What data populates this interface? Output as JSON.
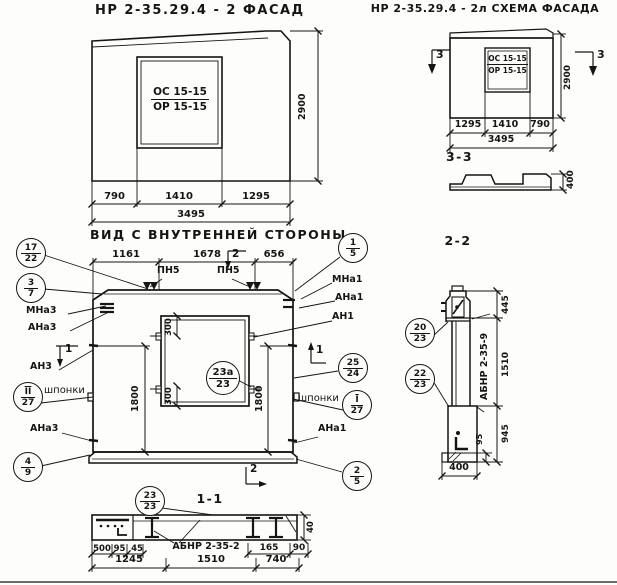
{
  "colors": {
    "ink": "#151515",
    "paper": "#fdfdfb"
  },
  "facade_view": {
    "title": "НР 2-35.29.4 - 2 ФАСАД",
    "window_mark": {
      "top": "ОС 15-15",
      "bottom": "ОР 15-15"
    },
    "dims": {
      "height": "2900",
      "left": "790",
      "middle": "1410",
      "right": "1295",
      "total": "3495"
    }
  },
  "scheme_view": {
    "title": "НР 2-35.29.4 - 2л СХЕМА ФАСАДА",
    "window_mark": {
      "top": "ОС 15-15",
      "bottom": "ОР 15-15"
    },
    "section_mark_left": "3",
    "section_mark_right": "3",
    "dims": {
      "height": "2900",
      "left": "1295",
      "middle": "1410",
      "right": "790",
      "total": "3495"
    }
  },
  "section_3_3": {
    "title": "3-3",
    "dims": {
      "thickness": "400"
    }
  },
  "inner_view": {
    "title": "ВИД С ВНУТРЕННЕЙ СТОРОНЫ",
    "dims": {
      "top_left": "1161",
      "top_middle": "1678",
      "top_right": "656",
      "window_offset_top": "300",
      "window_offset_bottom": "300",
      "height_left": "1800",
      "height_right": "1800"
    },
    "section_marks": {
      "top": "2",
      "bottom": "2",
      "left": "1",
      "right": "1"
    },
    "weld_marks": {
      "left": "ПН5",
      "right": "ПН5"
    },
    "part_labels": {
      "mna3": "МНа3",
      "ana3_top": "АНа3",
      "an3": "АН3",
      "shponki_left": "шпонки",
      "ana3_bottom": "АНа3",
      "mna1": "МНа1",
      "ana1_top": "АНа1",
      "an1": "АН1",
      "shponki_right": "шпонки",
      "ana1_bottom": "АНа1"
    },
    "callouts": {
      "c17_22": {
        "top": "17",
        "bottom": "22"
      },
      "c3_7": {
        "top": "3",
        "bottom": "7"
      },
      "c11_27": {
        "top": "II",
        "bottom": "27"
      },
      "c4_9": {
        "top": "4",
        "bottom": "9"
      },
      "c1_5": {
        "top": "1",
        "bottom": "5"
      },
      "c25_24": {
        "top": "25",
        "bottom": "24"
      },
      "c1_27": {
        "top": "I",
        "bottom": "27"
      },
      "c2_5": {
        "top": "2",
        "bottom": "5"
      },
      "c23a_23": {
        "top": "23а",
        "bottom": "23"
      }
    }
  },
  "section_1_1": {
    "title": "1-1",
    "callout": {
      "top": "23",
      "bottom": "23"
    },
    "beam_mark": "АБНР 2-35-2",
    "dims": {
      "d500": "500",
      "d95": "95",
      "d45": "45",
      "d165": "165",
      "d90": "90",
      "d40": "40",
      "left": "1245",
      "middle": "1510",
      "right": "740"
    }
  },
  "section_2_2": {
    "title": "2-2",
    "beam_mark": "АБНР 2-35-9",
    "callouts": {
      "c20_23": {
        "top": "20",
        "bottom": "23"
      },
      "c22_23": {
        "top": "22",
        "bottom": "23"
      }
    },
    "dims": {
      "top": "445",
      "middle": "1510",
      "bottom": "945",
      "lip": "95",
      "width": "400"
    }
  }
}
